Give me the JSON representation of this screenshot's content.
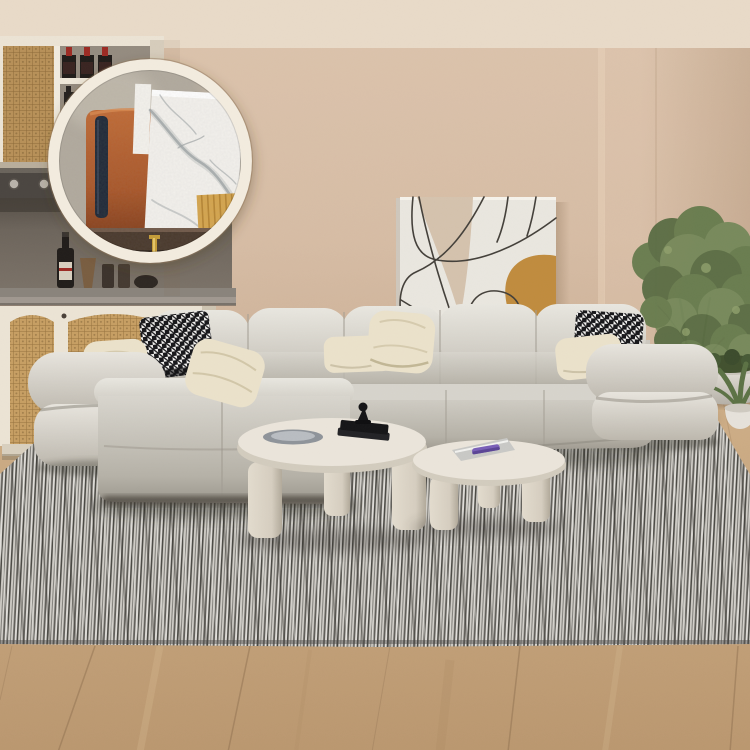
{
  "image": {
    "kind": "furniture product photo",
    "alt": "Beige living room with light gray tufted modular sectional sofa, two round cream nesting coffee tables, striped gray rug, abstract line-art canvas, rattan bar cabinet with wine bottles, potted green tree, and a round magnifier inset showing a zoomed material detail of marble, terracotta leather and oak wood"
  },
  "colors": {
    "wall": "#d7bda5",
    "wall_right_panel": "#e0c7af",
    "ceiling": "#e9dbc9",
    "floor": "#c9a981",
    "floor_dark": "#bb9870",
    "wood_seam": "#8e7051",
    "rug_base": "#d3d0ca",
    "rug_stripe": "#35342f",
    "rug_white": "#f0efec",
    "sofa_light": "#e2dfd8",
    "sofa_mid": "#cdc9c0",
    "sofa_dark": "#a39e94",
    "sofa_crevice": "#6e6961",
    "pillow_cream": "#ebe2cb",
    "houndstooth_black": "#17171a",
    "houndstooth_white": "#f4f3f1",
    "cabinet_frame": "#ece4d5",
    "rattan": "#c79f63",
    "rattan_line": "#8a6634",
    "rattan_dot": "#5e4423",
    "counter_dark": "#4b4641",
    "niche_back": "#6d655c",
    "stone_top": "#8a847c",
    "wine_red": "#9c2b24",
    "bottle_dark": "#211d1a",
    "table_cream": "#ebe5db",
    "table_rim": "#d3ccbe",
    "plate_gray": "#8f949a",
    "book_black": "#151517",
    "magazine_gray": "#c9c9c6",
    "accent_purple": "#7a5fb8",
    "art_bg": "#eae7e0",
    "art_beige": "#d3bfa9",
    "art_orange": "#c08c3e",
    "art_line": "#44403a",
    "plant_green_dark": "#5a6d44",
    "plant_green": "#677b4e",
    "plant_green_light": "#75895a",
    "trunk_brown": "#6f5a42",
    "moss": "#42512f",
    "pot_white": "#dfdbd3",
    "lens_ring": "#f3ecdf",
    "lens_fabric": "#b2ab9f",
    "lens_marble": "#f4f2ee",
    "marble_vein": "#9fa5a7",
    "lens_leather": "#a9572a",
    "lens_navy": "#212a38",
    "lens_wood": "#d6a64e",
    "lens_wood_line": "#b07f2e",
    "lens_counter": "#4a392c",
    "lens_gold": "#c79d35"
  }
}
